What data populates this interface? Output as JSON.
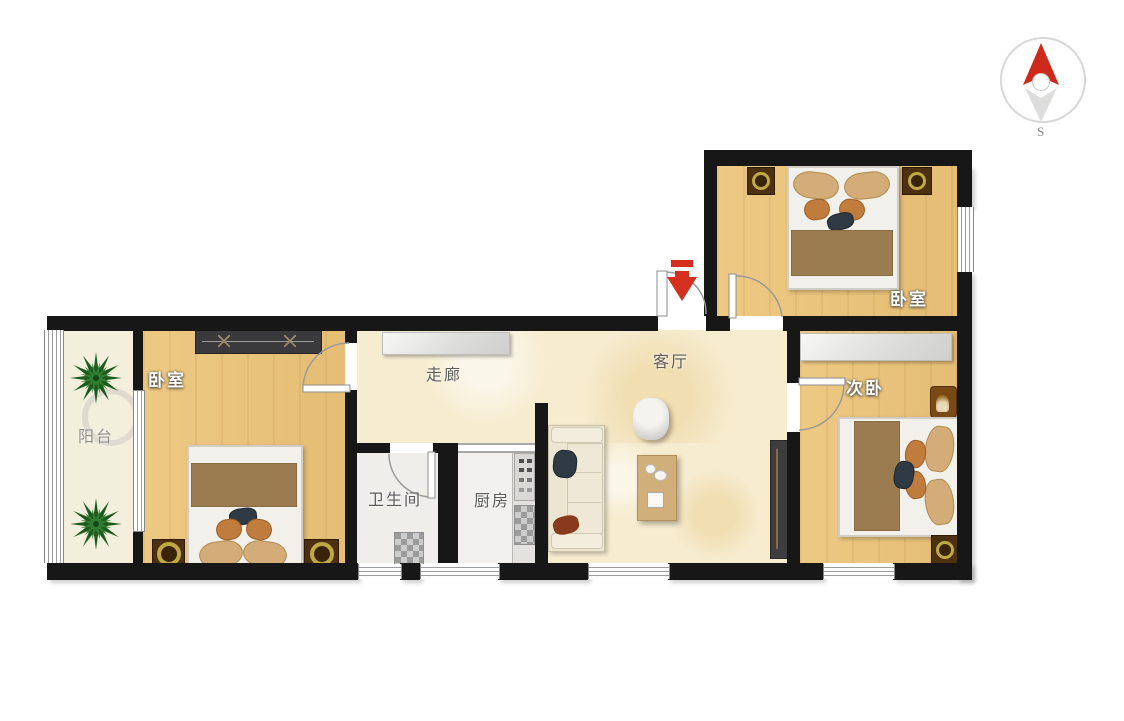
{
  "title": "apartment-floor-plan",
  "compass": {
    "south_label": "S"
  },
  "rooms": {
    "balcony": {
      "label": "阳台"
    },
    "bedroom_main": {
      "label": "卧室"
    },
    "corridor": {
      "label": "走廊"
    },
    "living_room": {
      "label": "客厅"
    },
    "bathroom": {
      "label": "卫生间"
    },
    "kitchen": {
      "label": "厨房"
    },
    "bedroom_top": {
      "label": "卧室"
    },
    "bedroom_second": {
      "label": "次卧"
    }
  },
  "furniture": {
    "bedroom_main": [
      "wardrobe",
      "double-bed",
      "nightstand",
      "nightstand"
    ],
    "balcony": [
      "plant",
      "plant"
    ],
    "corridor": [
      "cabinet"
    ],
    "bathroom": [
      "toilet"
    ],
    "kitchen": [
      "counter-with-stove"
    ],
    "living_room": [
      "sofa",
      "round-chair",
      "coffee-table",
      "tv-cabinet"
    ],
    "bedroom_top": [
      "double-bed",
      "nightstand",
      "nightstand"
    ],
    "bedroom_second": [
      "cabinet",
      "armchair",
      "double-bed",
      "nightstand"
    ]
  },
  "symbols": {
    "entrance_arrow": "red-down-arrow",
    "doors": 5,
    "windows": 7
  },
  "colors": {
    "wall": "#171717",
    "wood_floor": "#eac47c",
    "tile_floor": "#f6ecd0",
    "balcony_floor": "#f3efdd",
    "accent_red": "#d52f1f",
    "blanket": "#9b7c50",
    "pillow": "#d3ac77",
    "nightstand_ring": "#bfa945"
  }
}
